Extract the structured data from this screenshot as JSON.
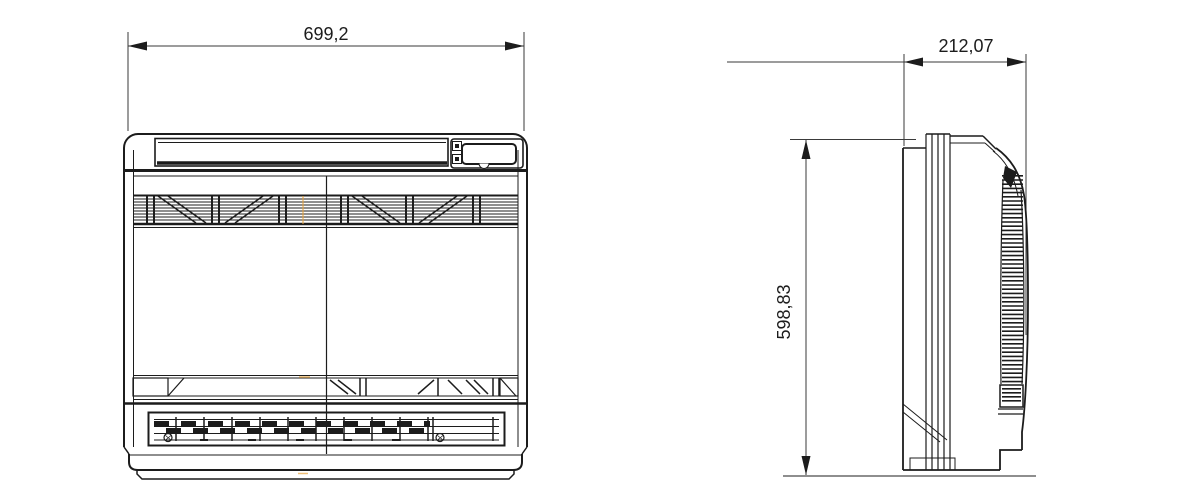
{
  "drawing": {
    "views": {
      "front": {
        "width_dimension": "699,2"
      },
      "side": {
        "depth_dimension": "212,07",
        "height_dimension": "598,83"
      }
    },
    "colors": {
      "line": "#1c1c1c",
      "dimension_line": "#3a3a3a",
      "background": "#ffffff",
      "centerline_mark": "#e7a33c"
    }
  }
}
